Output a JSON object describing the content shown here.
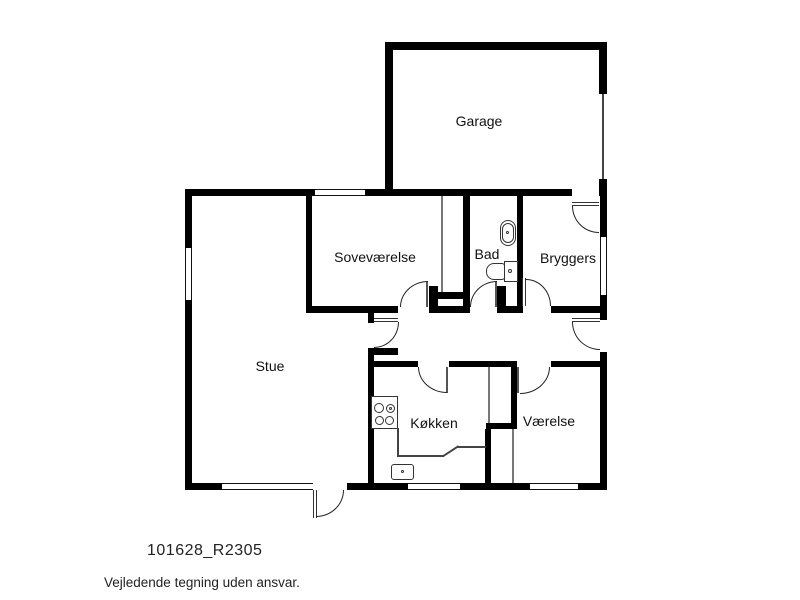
{
  "rooms": {
    "garage": "Garage",
    "sovevaerelse": "Soveværelse",
    "bad": "Bad",
    "bryggers": "Bryggers",
    "stue": "Stue",
    "koekken": "Køkken",
    "vaerelse": "Værelse"
  },
  "footer": {
    "drawing_number": "101628_R2305",
    "disclaimer": "Vejledende tegning uden ansvar."
  },
  "colors": {
    "wall": "#000000",
    "line": "#333333",
    "background": "#ffffff"
  },
  "fixtures": [
    "stove",
    "kitchen-sink",
    "washbasin",
    "toilet",
    "garage-door"
  ]
}
